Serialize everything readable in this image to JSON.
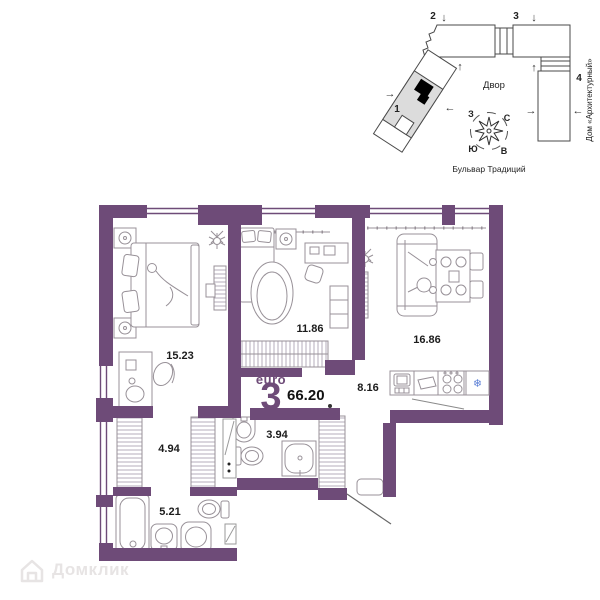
{
  "site_plan": {
    "courtyard": "Двор",
    "street": "Бульвар Традиций",
    "building_name": "Дом «Архитектурный»",
    "sections": {
      "s1": "1",
      "s2": "2",
      "s3": "3",
      "s4": "4"
    },
    "compass": {
      "north": "С",
      "south": "Ю",
      "west": "З",
      "east": "В"
    },
    "arrows": {
      "down": "↓",
      "up": "↑",
      "left": "←",
      "right": "→"
    }
  },
  "floor_plan": {
    "layout_type": "euro",
    "rooms_number": "3",
    "total_area": "66.20",
    "areas": {
      "bedroom1": "15.23",
      "bedroom2": "11.86",
      "living": "16.86",
      "kitchen": "8.16",
      "hallway": "4.94",
      "bathroom1": "3.94",
      "bathroom2": "5.21"
    }
  },
  "icons": {
    "fridge_snowflake": "❄"
  },
  "watermark": {
    "label": "Домклик"
  },
  "colors": {
    "wall_purple": "#6e4b78",
    "site_plan_line": "#4a4a4a",
    "fridge_blue": "#5b7fd6",
    "watermark_gray": "#e7e4e4"
  }
}
